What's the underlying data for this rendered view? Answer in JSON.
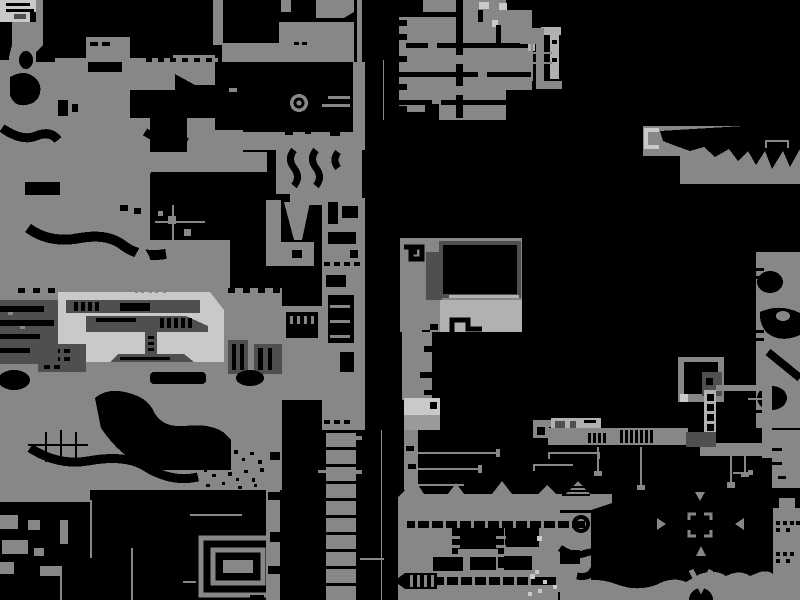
{
  "meta": {
    "title": "World map",
    "description": "Zoomed-out monochrome pixel map of a game world: gray terrain masses with black cave interiors on a black background",
    "width": 800,
    "height": 600
  },
  "palette": {
    "bg": "#000000",
    "terrain": "#878787",
    "gray2": "#9a9a9a",
    "midlight": "#b1b1b1",
    "light": "#c9c9c9",
    "dark": "#4f4f4f"
  },
  "markers": [
    {
      "name": "ring-eye",
      "shape": "concentric-circles",
      "x": 299,
      "y": 103
    },
    {
      "name": "droplet",
      "shape": "teardrop-hanging-from-wire",
      "x": 142,
      "y": 250
    },
    {
      "name": "c-bracket",
      "shape": "open-square-bracket",
      "x": 651,
      "y": 138
    },
    {
      "name": "reticle",
      "shape": "four-inward-triangles-with-corner-brackets",
      "x": 700,
      "y": 525
    },
    {
      "name": "v-chevron",
      "shape": "chevron-down",
      "x": 701,
      "y": 579
    },
    {
      "name": "ring-outline",
      "shape": "circle-outline",
      "x": 581,
      "y": 524
    },
    {
      "name": "spiral-maze",
      "shape": "nested-rectangles",
      "x": 238,
      "y": 566
    },
    {
      "name": "speckle-field",
      "shape": "dotted-texture",
      "x": 240,
      "y": 468
    }
  ]
}
